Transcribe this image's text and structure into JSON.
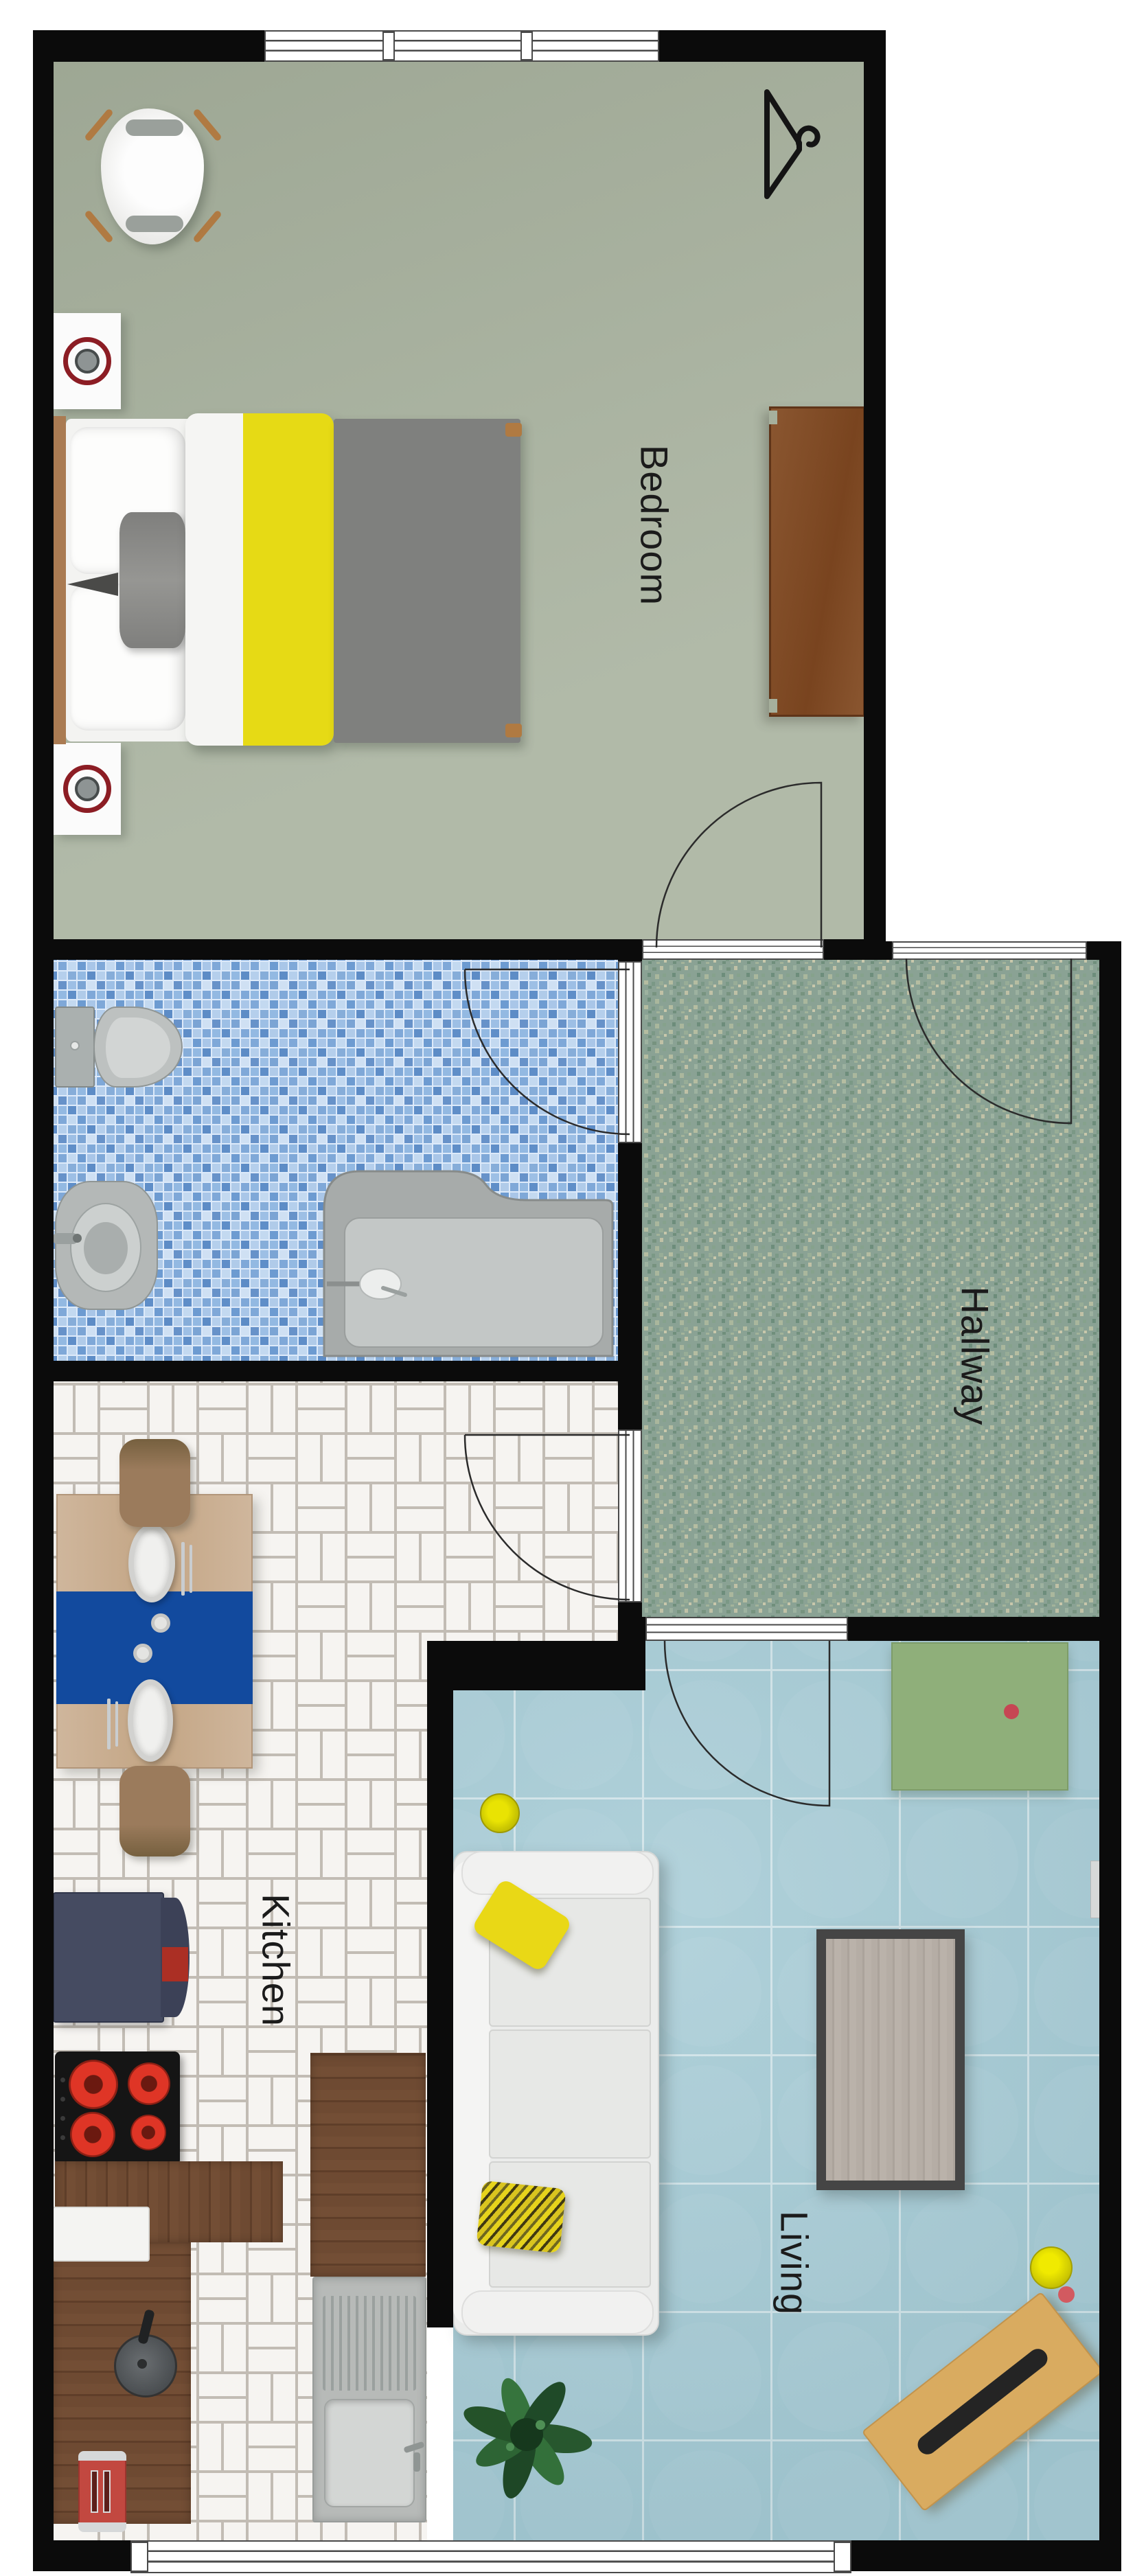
{
  "plan": {
    "type": "apartment-floor-plan-top-view",
    "labels": {
      "bedroom": "Bedroom",
      "hallway": "Hallway",
      "kitchen": "Kitchen",
      "living": "Living"
    },
    "rooms": [
      {
        "name": "Bedroom",
        "floor_color": "#a6b09c",
        "furniture": [
          "double-bed",
          "armchair",
          "speaker",
          "speaker",
          "dresser",
          "clothes-hanger-symbol"
        ]
      },
      {
        "name": "Bathroom",
        "floor_color": "#7fa8d8",
        "furniture": [
          "toilet",
          "bidet",
          "bathtub"
        ]
      },
      {
        "name": "Hallway",
        "floor_color": "#8aa294",
        "furniture": []
      },
      {
        "name": "Kitchen",
        "floor_color": "#f4f2ef",
        "furniture": [
          "dining-table",
          "dining-chair",
          "dining-chair",
          "refrigerator",
          "cooktop",
          "wood-counter",
          "cutting-board",
          "coffee-maker",
          "toaster",
          "sink"
        ]
      },
      {
        "name": "Living",
        "floor_color": "#a7ccd6",
        "furniture": [
          "sofa",
          "coffee-table",
          "sideboard",
          "wooden-bench",
          "plant",
          "stool",
          "stool"
        ]
      }
    ],
    "doors": [
      {
        "from": "Bedroom",
        "to": "Hallway",
        "swing": "into-bedroom"
      },
      {
        "from": "Hallway",
        "to": "outside",
        "swing": "into-hallway"
      },
      {
        "from": "Bathroom",
        "to": "Hallway",
        "swing": "into-bathroom"
      },
      {
        "from": "Kitchen",
        "to": "Hallway",
        "swing": "into-kitchen"
      },
      {
        "from": "Living",
        "to": "Hallway",
        "swing": "into-living"
      }
    ],
    "windows": [
      {
        "wall": "top",
        "room": "Bedroom"
      },
      {
        "wall": "bottom",
        "rooms": "Kitchen-Living"
      }
    ],
    "colors": {
      "wall": "#0b0b0b",
      "accent_yellow": "#e6da15",
      "runner_blue": "#124a9e",
      "burner_red": "#df3526",
      "sideboard_green": "#8faf7a",
      "bath_tile_blue": "#7fa8d8",
      "hallway_mosaic_green": "#8aa294",
      "living_tile_blue": "#a7ccd6",
      "wood_dark": "#6e4a32",
      "wood_light": "#cfb69c"
    }
  }
}
